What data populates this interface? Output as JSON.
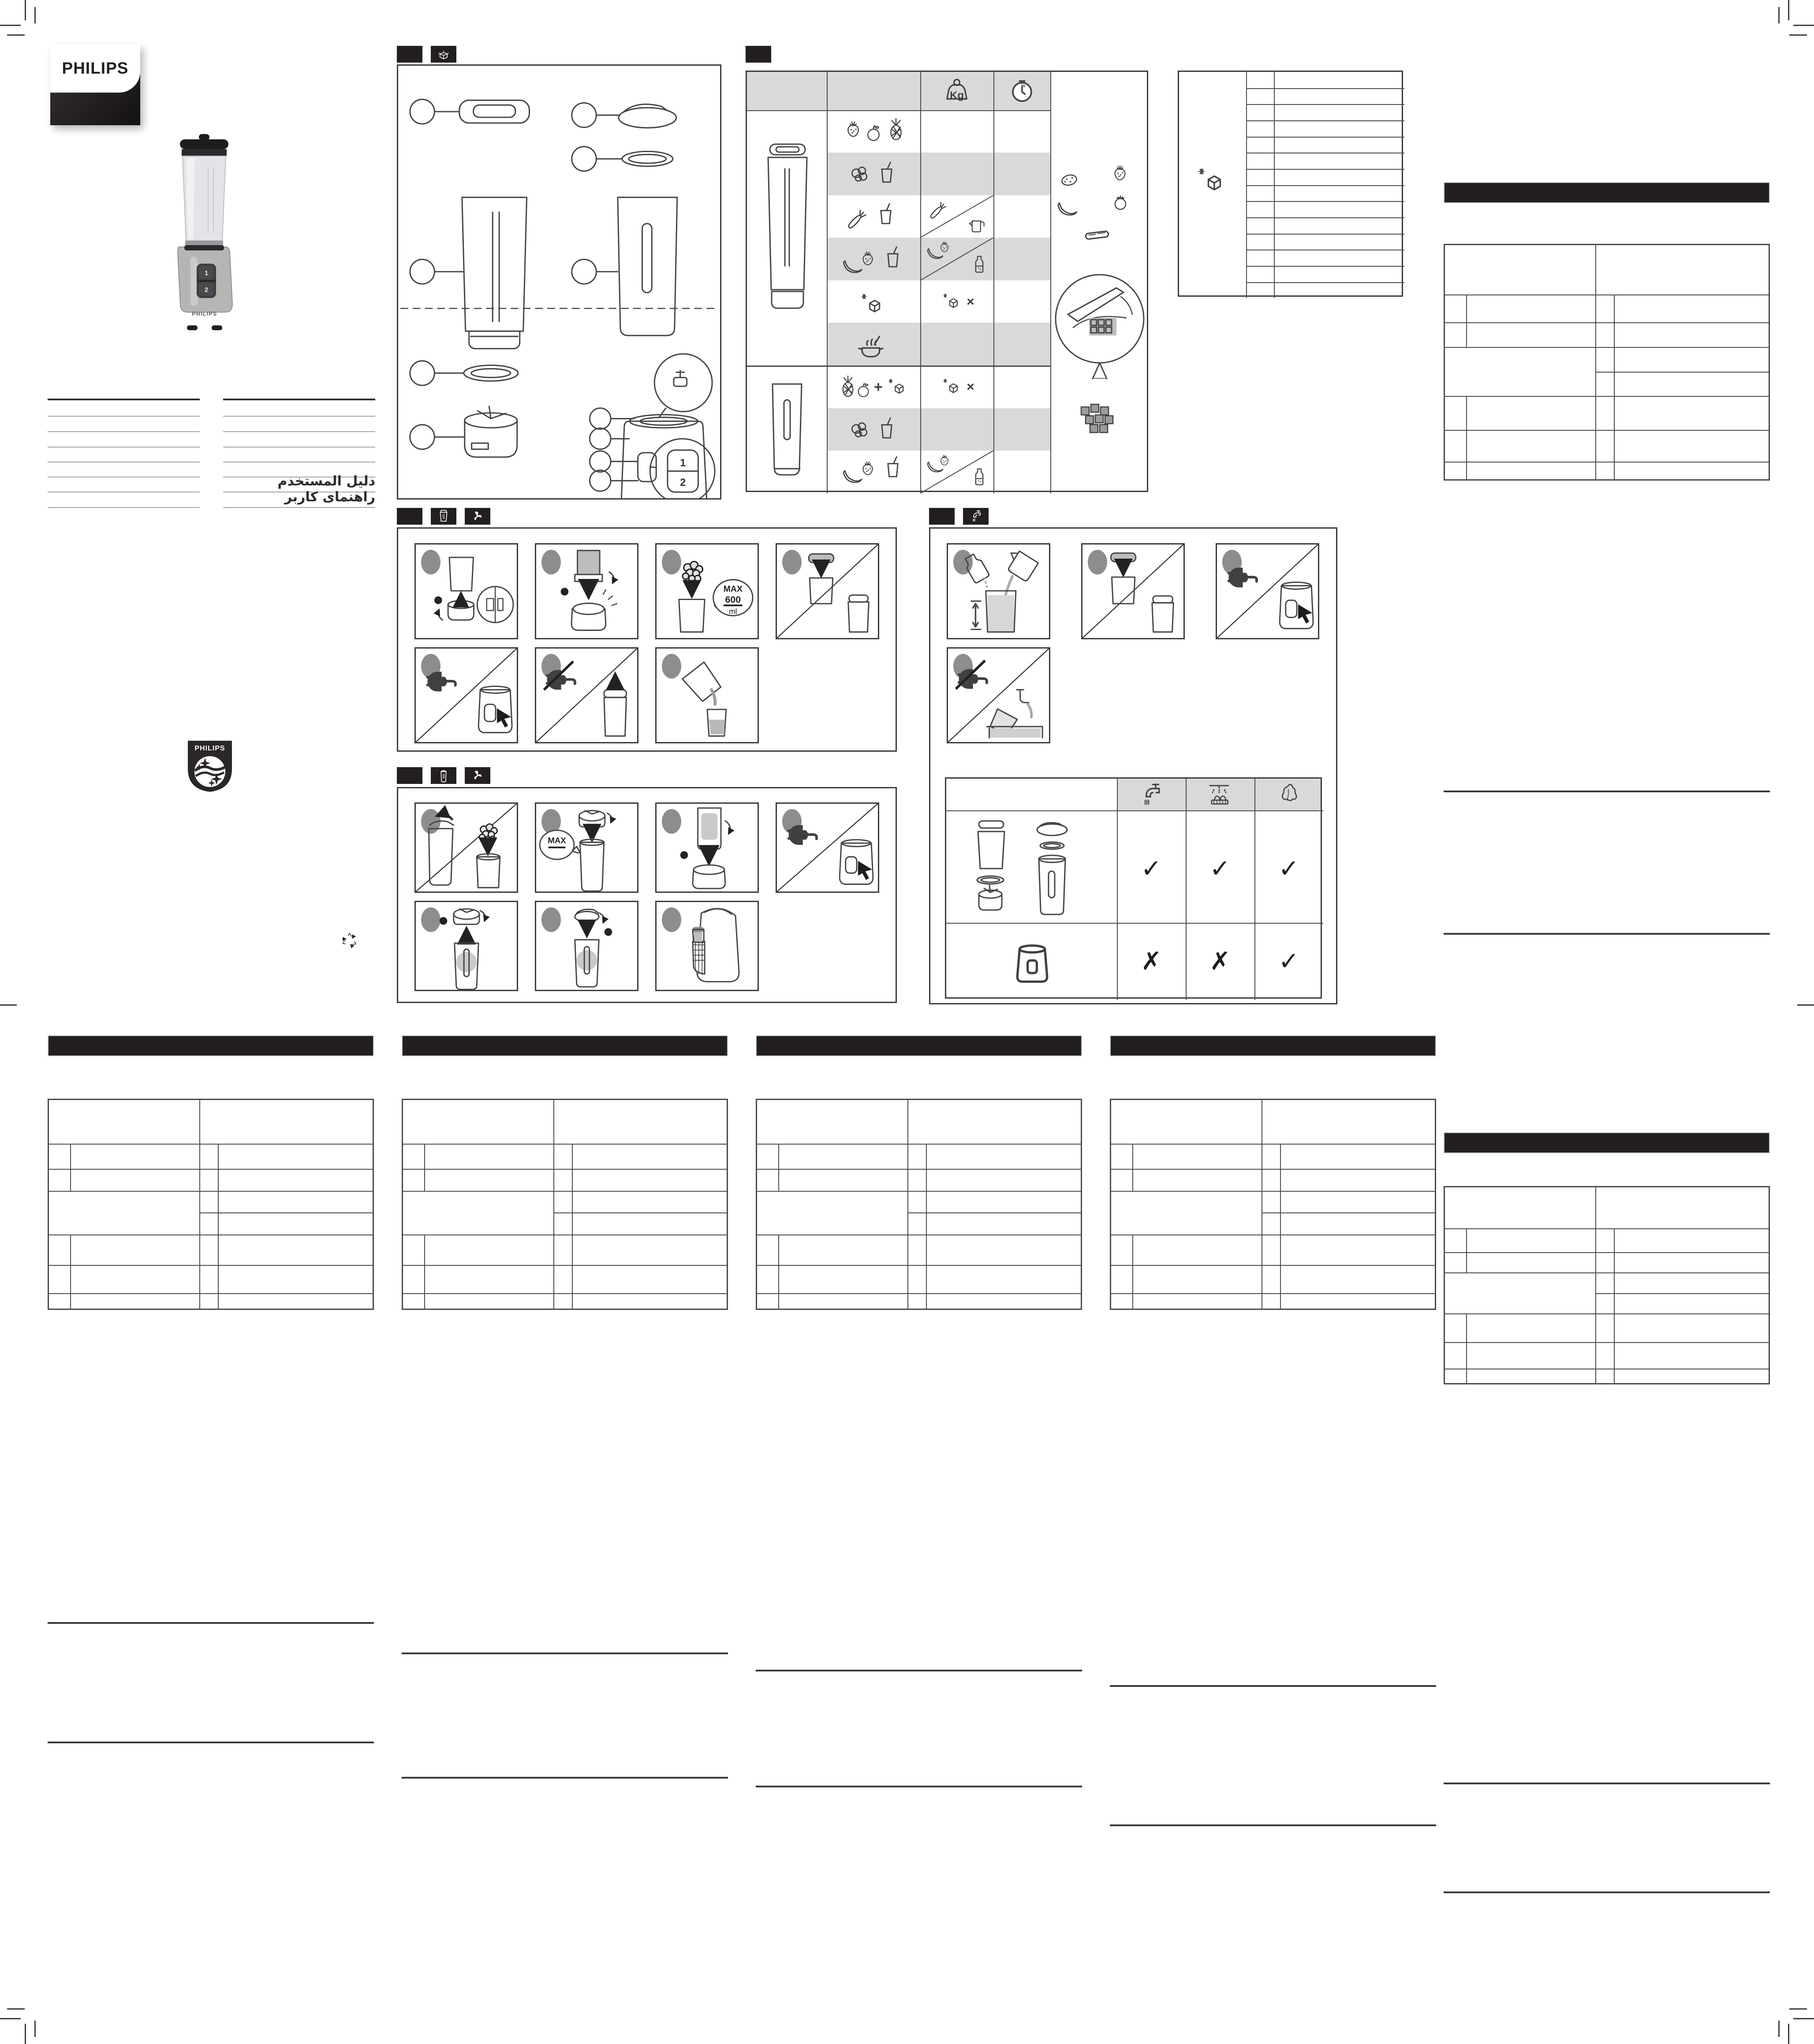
{
  "brand": {
    "wordmark": "PHILIPS"
  },
  "product": {
    "body_label": "PHILIPS",
    "speed_buttons": [
      "1",
      "2"
    ]
  },
  "cover": {
    "user_manual_arabic": "دليل المستخدم",
    "user_guide_persian": "راهنمای کاربر"
  },
  "recipe_panel": {
    "weight_unit": "Kg",
    "ice_multiplier": "×",
    "plus": "+"
  },
  "jar_steps": {
    "max_bubble": {
      "l1": "MAX",
      "l2": "600",
      "l3": "ml"
    }
  },
  "tumbler_steps": {
    "max_label": "MAX"
  },
  "cleaning_table": {
    "rows": [
      {
        "name": "detachable-parts",
        "marks": [
          "✓",
          "✓",
          "✓"
        ]
      },
      {
        "name": "motor-unit",
        "marks": [
          "✗",
          "✗",
          "✓"
        ]
      }
    ]
  }
}
